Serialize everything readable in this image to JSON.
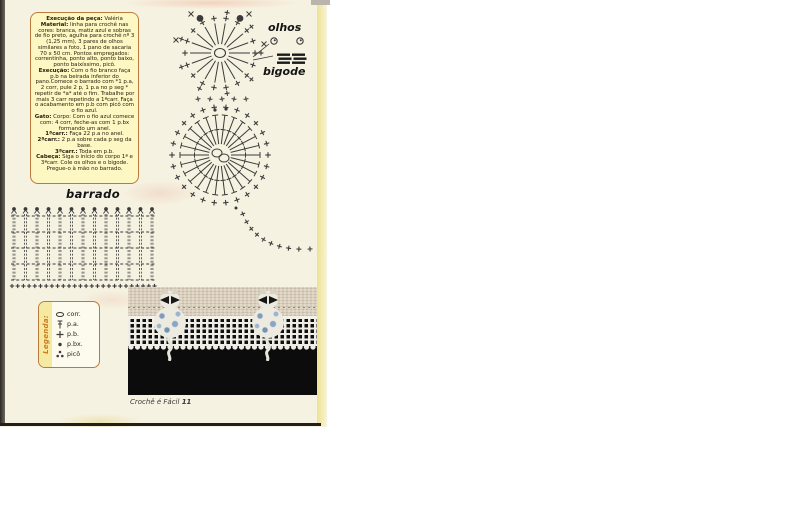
{
  "colors": {
    "page_bg": "#f6f2e1",
    "box_bg": "#fdf8c3",
    "box_border": "#b97a3c",
    "legend_accent": "#cd7a1c",
    "diagram_stroke": "#3b3b3b",
    "photo_black": "#0c0c0c",
    "photo_beige": "#d9cebb",
    "lace_white": "#efeee6",
    "cat_blue": "#7d9cc0"
  },
  "instructions": {
    "paragraphs": [
      [
        {
          "b": "Execução da peça:"
        },
        {
          "t": " Valéria"
        }
      ],
      [
        {
          "b": "Material:"
        },
        {
          "t": " linha para crochê nas cores: branca, matiz azul e sobras de fio preto, agulha para crochê nº 3 (1,25 mm), 3 pares de olhos similares a foto, 1 pano de sacaria 70 x 50 cm. Pontos empregados: correntinha, ponto alto, ponto baixo, ponto baixíssimo, picô."
        }
      ],
      [
        {
          "b": "Execução:"
        },
        {
          "t": " Com o fio branco faça p.b na beirada inferior do pano.Comece o barrado com *1 p.a, 2 corr, pule 2 p, 1 p.a no p seg * repetir de *a* até o fim. Trabalhe por mais 3 carr repetindo a 1ªcarr. Faça o acabamento em p.b com picô com o fio azul."
        }
      ],
      [
        {
          "b": "Gato:"
        },
        {
          "t": " Corpo: Com o fio azul comece com: 4 corr, feche-as com 1 p.bx formando um anel."
        }
      ],
      [
        {
          "b": "1ªcarr.:"
        },
        {
          "t": " Faça 22 p.a no anel. "
        },
        {
          "b": "2ªcarr.:"
        },
        {
          "t": " 2 p.a sobre cada p seg da base."
        }
      ],
      [
        {
          "b": "3ªcarr.:"
        },
        {
          "t": " Toda em p.b."
        }
      ],
      [
        {
          "b": "Cabeça:"
        },
        {
          "t": " Siga o início do corpo 1ª e 3ªcarr. Cole os olhos e o bigode. Pregue-o à mão no barrado."
        }
      ]
    ]
  },
  "labels": {
    "barrado": "barrado",
    "olhos": "olhos",
    "bigode": "bigode"
  },
  "legend": {
    "title": "Legenda:",
    "items": [
      {
        "symbol": "chain",
        "label": "corr."
      },
      {
        "symbol": "treble",
        "label": "p.a."
      },
      {
        "symbol": "sc",
        "label": "p.b."
      },
      {
        "symbol": "slip",
        "label": "p.bx."
      },
      {
        "symbol": "picot",
        "label": "picô"
      }
    ]
  },
  "caption": {
    "text": "Crochê é Fácil ",
    "page": "11"
  },
  "diagrams": {
    "head": {
      "cx": 220,
      "cy": 53,
      "spokes": 18,
      "r_inner": 9,
      "r_outer": 30,
      "r_plus": 35,
      "r_plus2": 41,
      "ear_angles_deg": [
        240,
        300
      ],
      "ear_r": 40,
      "ear_size": 3.4,
      "x_marks": [
        [
          191,
          14
        ],
        [
          249,
          14
        ],
        [
          176,
          40
        ],
        [
          264,
          44
        ]
      ]
    },
    "neck": {
      "row_y": 99,
      "row_x0": 198,
      "row_step": 12,
      "row_count": 5,
      "dots": [
        [
          215,
          110
        ],
        [
          226,
          109
        ]
      ]
    },
    "body": {
      "cx": 220,
      "cy": 155,
      "spokes": 26,
      "r_inner": 11,
      "r_outer": 40,
      "r_plus": 48
    },
    "tail": {
      "p0": [
        240,
        205
      ],
      "p1": [
        252,
        252
      ],
      "p2": [
        310,
        249
      ],
      "count": 10
    },
    "grid": {
      "x": 14,
      "y": 216,
      "cols": 12,
      "cellw": 11.5,
      "rows": 4,
      "rowh": 16,
      "plus_step": 5.7
    },
    "eyes": {
      "positions": [
        [
          274,
          41
        ],
        [
          300,
          41
        ]
      ],
      "r": 3.2
    },
    "whiskers": {
      "x": 277,
      "y": 53.5,
      "rows": 3,
      "bar_w": 13,
      "bar_h": 2.4,
      "row_gap": 4
    },
    "photo_cats": {
      "lefts": [
        22,
        120
      ]
    }
  }
}
